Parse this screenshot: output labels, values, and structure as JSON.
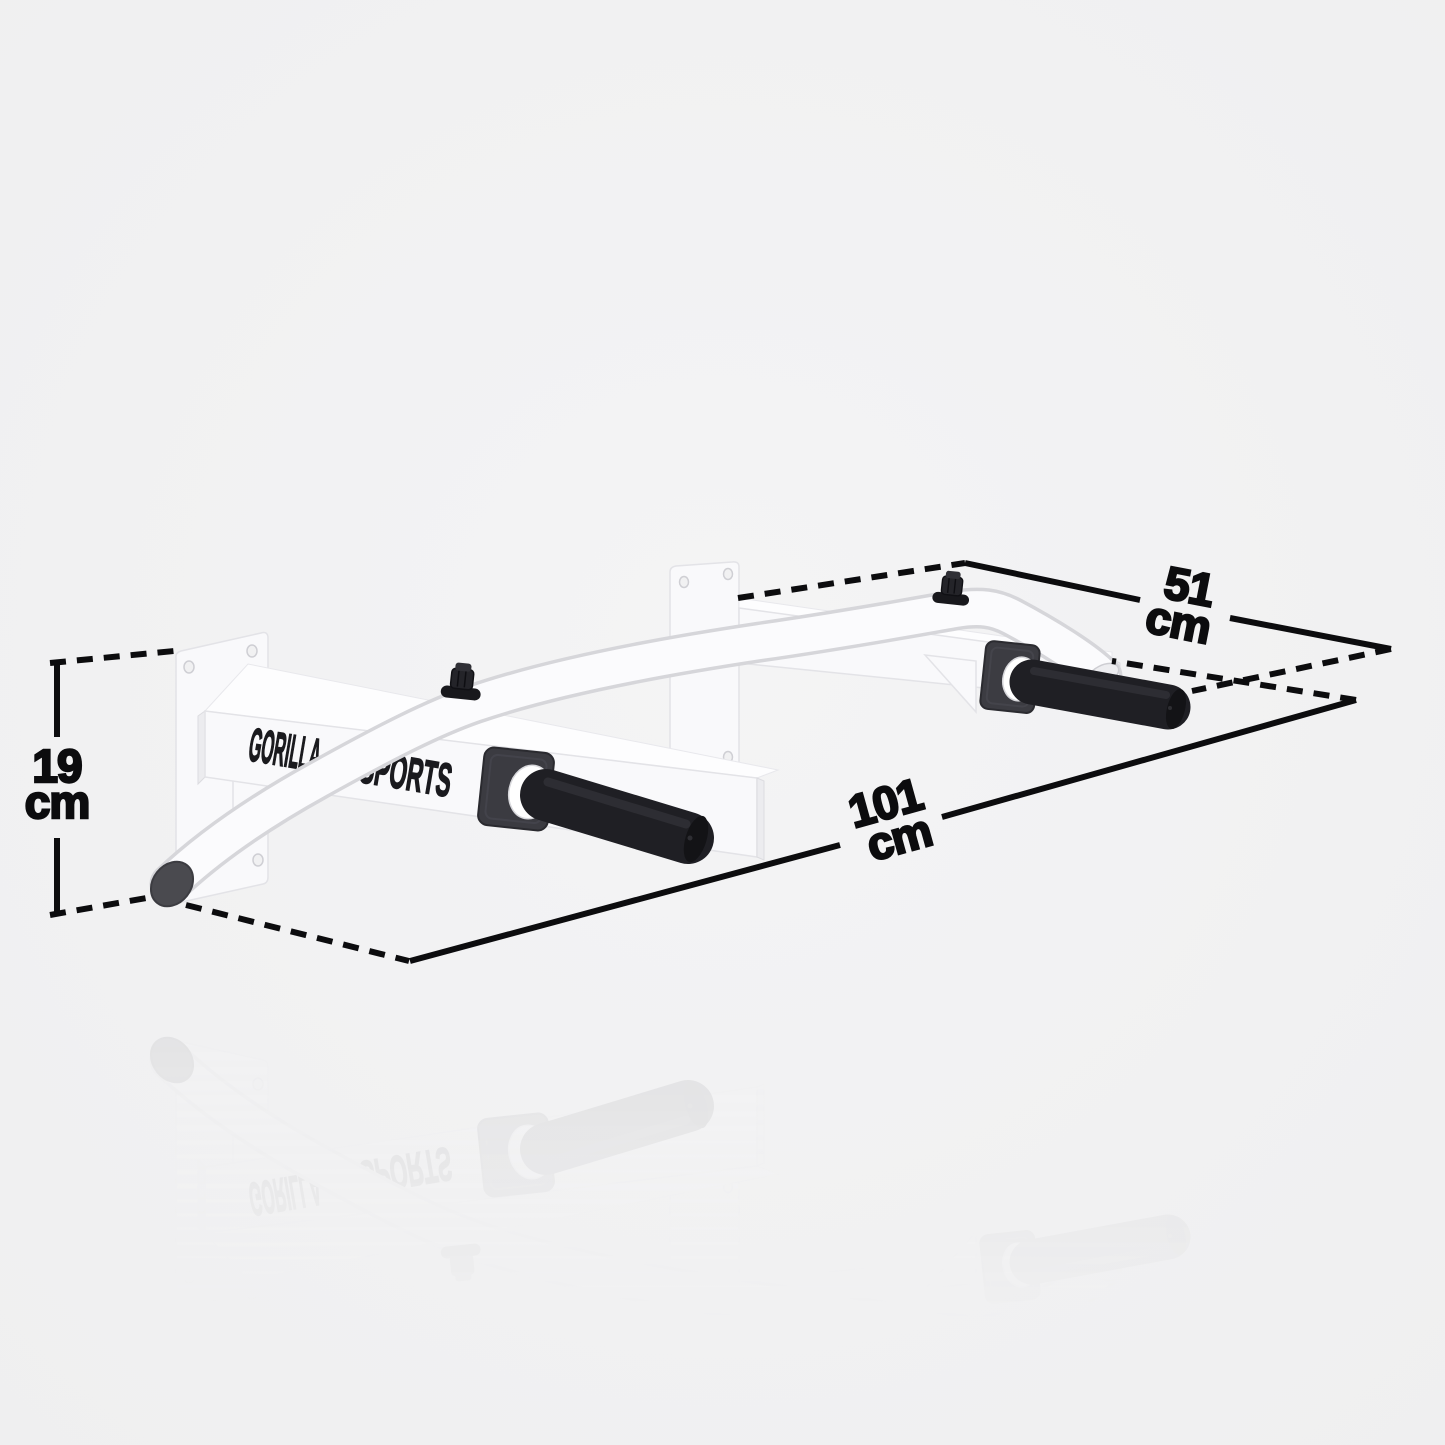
{
  "image": {
    "description": "White wall-mounted pull-up bar product render with measurement annotations and floor reflection",
    "background": "#f1f1f2"
  },
  "brand": {
    "name": "GORILLA SPORTS",
    "word_left": "GORILLA",
    "word_right": "SPORTS",
    "icon": "gorilla-silhouette-icon"
  },
  "dims": {
    "height": {
      "value": "19",
      "unit": "cm"
    },
    "depth": {
      "value": "51",
      "unit": "cm"
    },
    "width": {
      "value": "101",
      "unit": "cm"
    }
  },
  "colors": {
    "bg": "#f1f1f2",
    "line": "#0c0c0e",
    "steel": "#fafafb",
    "steel-edge": "#d8d8dd",
    "grip": "#1f1f24",
    "flange": "#3b3b41",
    "cap": "#47474c"
  }
}
